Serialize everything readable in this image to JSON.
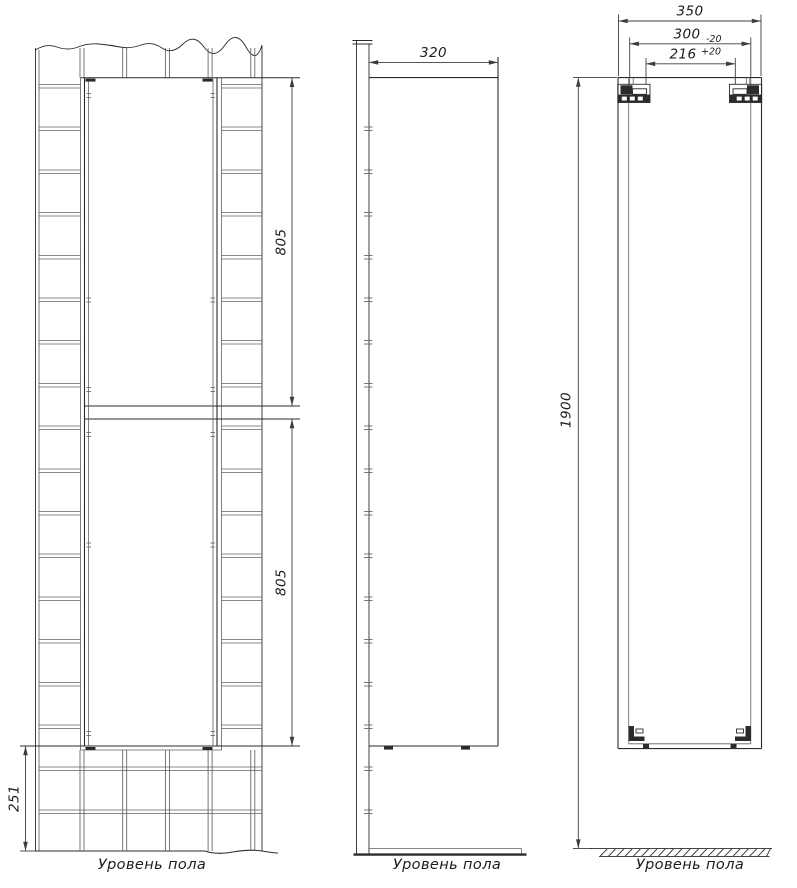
{
  "drawing": {
    "front_view": {
      "dim_upper_door": "805",
      "dim_lower_door": "805",
      "dim_bottom_gap": "251",
      "floor_label": "Уровень пола"
    },
    "side_view": {
      "dim_depth": "320",
      "floor_label": "Уровень пола"
    },
    "back_view": {
      "dim_width": "350",
      "dim_hanger_outer": "300",
      "dim_hanger_outer_tol": "-20",
      "dim_hanger_inner": "216",
      "dim_hanger_inner_tol": "+20",
      "dim_height": "1900",
      "floor_label": "Уровень пола"
    }
  },
  "colors": {
    "background": "#ffffff",
    "line": "#2b2b2b",
    "grout": "#606060",
    "dim": "#3d3d3d",
    "text": "#1c1c1c"
  }
}
